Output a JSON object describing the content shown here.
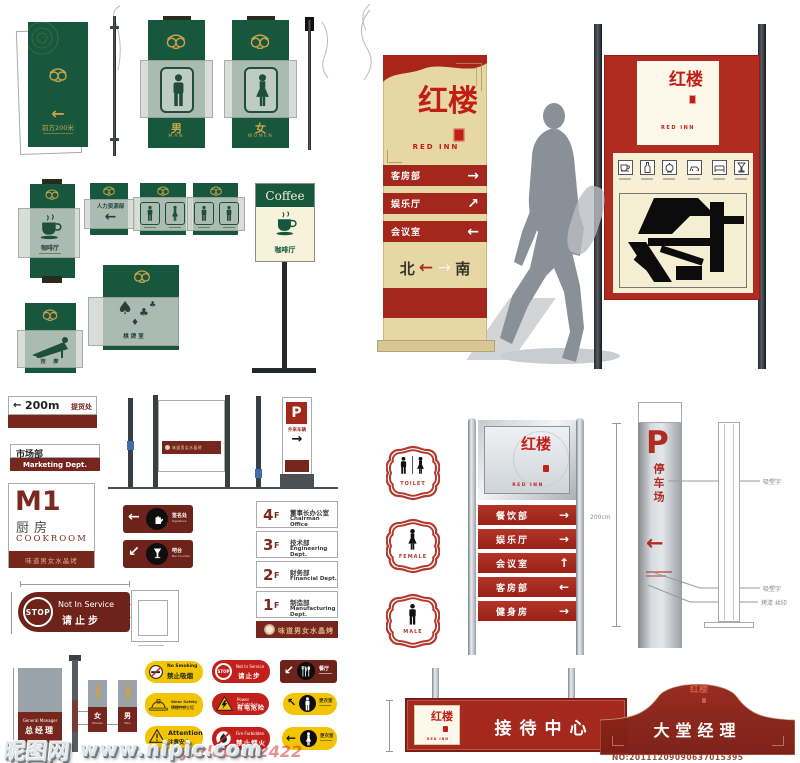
{
  "brand": {
    "cn": "红楼",
    "en": "RED INN"
  },
  "colors": {
    "green": "#17573e",
    "gold": "#c9a24b",
    "maroon": "#76261c",
    "brand_red": "#ab241c",
    "cream": "#e7d7a4",
    "yellow": "#f2c500",
    "warning_red": "#c4201b"
  },
  "green_system": {
    "banner": {
      "arrow": "←",
      "label": "前方200米"
    },
    "male": {
      "cn": "男",
      "en": "MAN"
    },
    "female": {
      "cn": "女",
      "en": "WOMEN"
    },
    "coffee_vertical": {
      "cn": "咖啡厅"
    },
    "hr": {
      "cn": "人力资源部",
      "arrow": "←"
    },
    "coffee_post": {
      "en": "Coffee",
      "cn": "咖啡厅"
    },
    "massage": {
      "cn": "按 摩"
    },
    "chess": {
      "cn": "棋牌室",
      "suits": [
        "♠",
        "♣",
        "♦",
        "♣"
      ]
    }
  },
  "pylon": {
    "rows": [
      {
        "label": "客房部",
        "arrow": "→"
      },
      {
        "label": "娱乐厅",
        "arrow": "↗"
      },
      {
        "label": "会议室",
        "arrow": "←"
      }
    ],
    "north": "北",
    "south": "南",
    "arrow_left": "←",
    "arrow_right": "→"
  },
  "left_system": {
    "d200": {
      "arrow": "←",
      "dist": "200m",
      "label": "提货处"
    },
    "market": {
      "cn": "市场部",
      "en": "Marketing Dept."
    },
    "m1": {
      "code": "M1",
      "cn": "厨房",
      "en": "COOKROOM",
      "footer": "味道男女水晶烤"
    },
    "stop": {
      "badge": "STOP",
      "en": "Not In Service",
      "cn": "请止步"
    },
    "manager": {
      "en": "General Manager",
      "cn": "总经理"
    },
    "wc_female": {
      "cn": "女",
      "en": "Women"
    },
    "wc_male": {
      "cn": "男",
      "en": "Men"
    }
  },
  "mid": {
    "post_banner": "味道男女水晶烤",
    "parking_small": {
      "p": "P",
      "cn": "外来车辆",
      "arrow": "→"
    },
    "dir_sign": {
      "arrow": "←",
      "cn": "签名处",
      "en": "Signature"
    },
    "dir_bar": {
      "arrow": "↙",
      "cn": "吧台",
      "en": "Bar Counter"
    },
    "floors": [
      {
        "num": "4",
        "f": "F",
        "cn": "董事长办公室",
        "en": "Chairman Office"
      },
      {
        "num": "3",
        "f": "F",
        "cn": "技术部",
        "en": "Engineering Dept."
      },
      {
        "num": "2",
        "f": "F",
        "cn": "财务部",
        "en": "Financial Dept."
      },
      {
        "num": "1",
        "f": "F",
        "cn": "制造部",
        "en": "Manufacturing Dept."
      }
    ],
    "floors_footer": "味道男女水晶烤"
  },
  "warnings": {
    "no_smoking": {
      "en": "No Smoking",
      "cn": "禁止吸烟"
    },
    "not_in_service": {
      "badge": "STOP",
      "en": "Not In Service",
      "cn": "请止步"
    },
    "restaurant": {
      "arrow": "↙",
      "cn": "餐厅"
    },
    "helmet": {
      "en": "Wear Safety Helmet",
      "cn": "请戴好安全帽"
    },
    "power": {
      "en": "Power Substation",
      "cn": "有电危险"
    },
    "locker_m": {
      "arrow": "↖",
      "cn": "更衣室"
    },
    "attention": {
      "en": "Attention",
      "cn": "注意安全"
    },
    "fire": {
      "en": "Fire Forbidden",
      "cn": "禁止烟火"
    },
    "locker_f": {
      "arrow": "←",
      "cn": "更衣室"
    }
  },
  "right_system": {
    "oval_toilet": "TOILET",
    "oval_female": "FEMALE",
    "oval_male": "MALE",
    "slats": [
      {
        "label": "餐饮部",
        "arrow": "→"
      },
      {
        "label": "娱乐厅",
        "arrow": "→"
      },
      {
        "label": "会议室",
        "arrow": "↑"
      },
      {
        "label": "客房部",
        "arrow": "←"
      },
      {
        "label": "健身房",
        "arrow": "→"
      }
    ],
    "dim": "200cm",
    "parking": {
      "p": "P",
      "label": "停车场",
      "arrow": "←"
    },
    "notes": [
      "吸塑字",
      "吸塑字",
      "烤漆 丝印"
    ],
    "reception": "接待中心",
    "lobby": "大堂经理"
  },
  "watermark": {
    "site": "昵图网",
    "url": "www.nipic.com",
    "by": "By:zldddd2422",
    "serial": "NO:20111209090637015395"
  }
}
